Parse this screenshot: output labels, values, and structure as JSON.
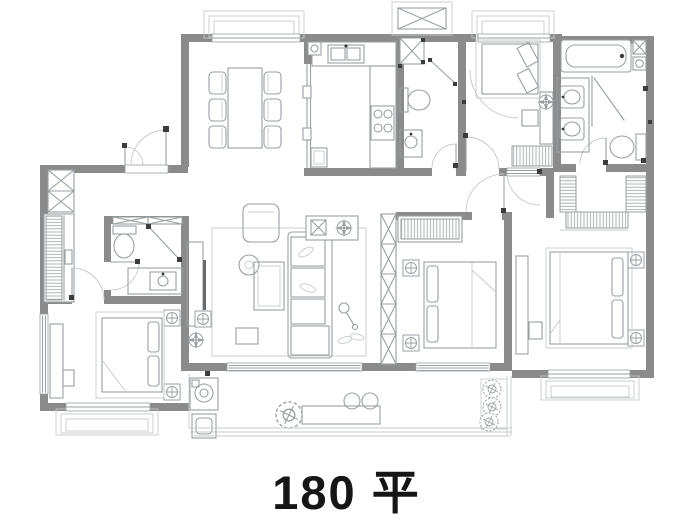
{
  "caption": {
    "text": "180 平"
  },
  "plan": {
    "type": "apartment-floor-plan",
    "area_value": "180",
    "area_unit": "平",
    "rooms": [
      "entry-hall",
      "dining-room",
      "kitchen",
      "guest-bathroom",
      "bedroom-top-right",
      "master-bathroom",
      "walk-in-closet",
      "hallway",
      "living-room",
      "bedroom-middle",
      "bedroom-right",
      "bedroom-bottom-left",
      "ensuite-bathroom",
      "balcony"
    ],
    "furniture_icons": [
      "dining-table-with-six-chairs",
      "kitchen-sink",
      "gas-stove",
      "fridge-cabinet",
      "toilet",
      "shower",
      "bathtub",
      "double-vanity",
      "vanity-sink",
      "double-bed",
      "pillows",
      "nightstand",
      "wardrobe",
      "desk",
      "stool",
      "sofa",
      "chaise",
      "armchair",
      "coffee-table",
      "round-side-table",
      "tv-cabinet",
      "floor-lamp",
      "rug",
      "washing-machine",
      "laundry-sink",
      "bench",
      "potted-plant",
      "duct-shaft",
      "door-swing",
      "window",
      "bay-window"
    ]
  },
  "colors": {
    "bg": "#ffffff",
    "wall": "#8b8b8b",
    "furn": "#9aa0a4",
    "thin": "#c6cacc",
    "dark": "#3c3c3c",
    "ink": "#161616"
  }
}
